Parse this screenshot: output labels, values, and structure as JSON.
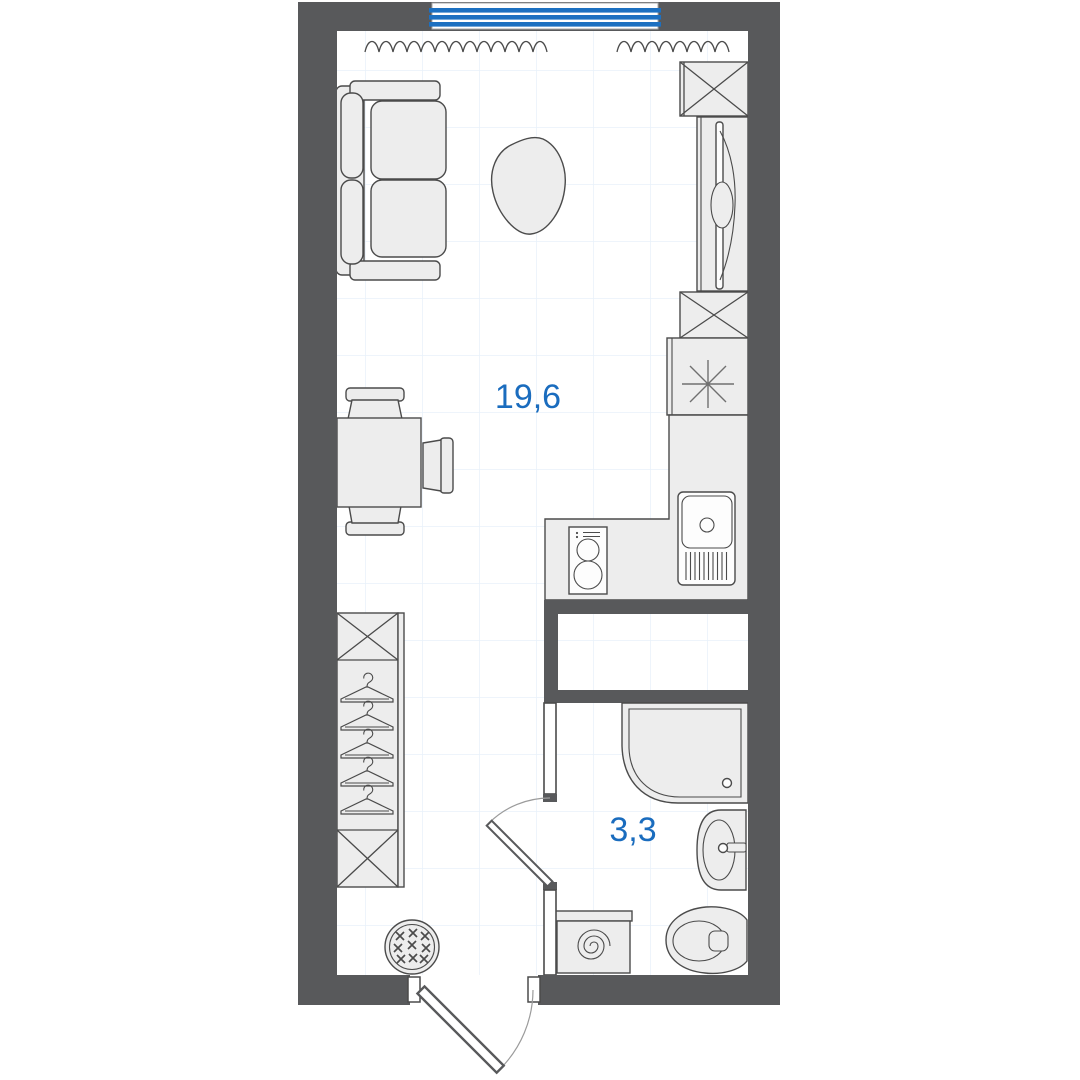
{
  "plan": {
    "title": "Studio apartment floor plan",
    "rooms": [
      {
        "name": "living-kitchen",
        "area_label": "19,6"
      },
      {
        "name": "bathroom",
        "area_label": "3,3"
      }
    ],
    "colors": {
      "wall": "#58595b",
      "outline": "#4b4b4b",
      "furniture_fill": "#ededed",
      "fixture_fill": "#fdfdfd",
      "accent_blue": "#1c70c1",
      "label_blue": "#1a6cbe",
      "grid": "#e8f1fa",
      "door_arc": "#9b9b9b",
      "floor": "#ffffff"
    },
    "symbols": [
      "window",
      "radiator",
      "sofa",
      "coffee-table",
      "dining-table",
      "chair",
      "wardrobe",
      "clothes-hanger",
      "laundry-basket",
      "vent-shaft",
      "tall-cabinet",
      "refrigerator",
      "kitchen-counter",
      "stove",
      "kitchen-sink",
      "shower-tray",
      "washbasin",
      "toilet",
      "washing-machine",
      "entry-door",
      "bathroom-door"
    ]
  }
}
